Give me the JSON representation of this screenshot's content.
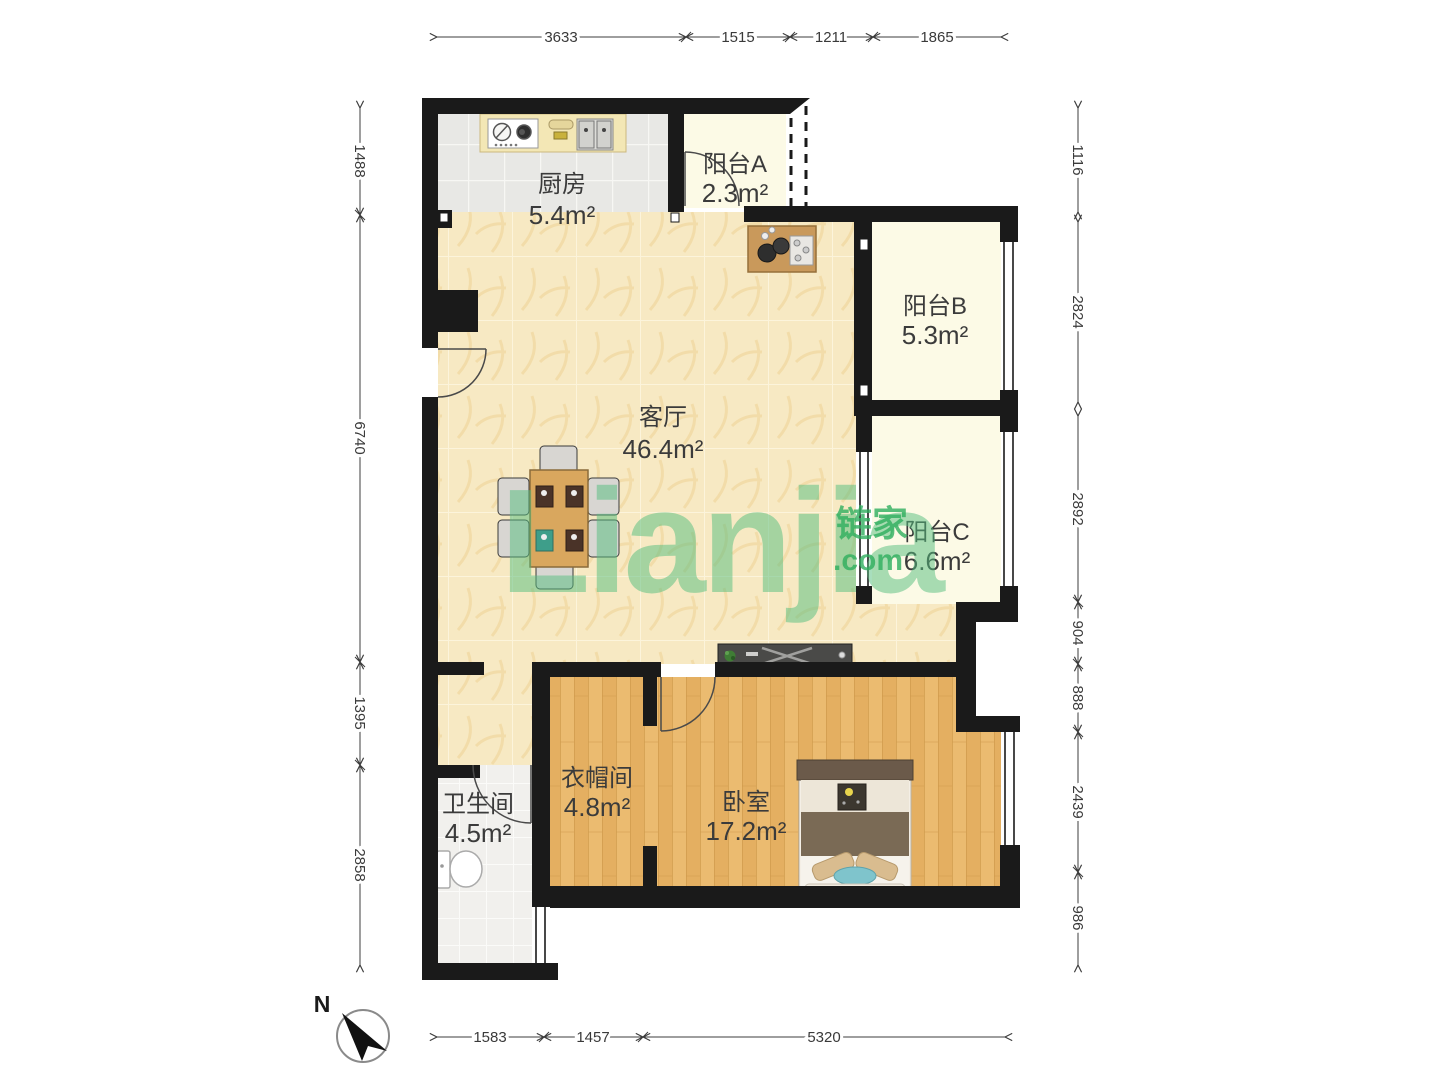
{
  "watermark": {
    "brand": "Lianjia",
    "tld": ".com",
    "cn": "链家"
  },
  "compass": {
    "north_label": "N"
  },
  "rooms": {
    "kitchen": {
      "name": "厨房",
      "area": "5.4m²"
    },
    "balcony_a": {
      "name": "阳台A",
      "area": "2.3m²"
    },
    "balcony_b": {
      "name": "阳台B",
      "area": "5.3m²"
    },
    "living": {
      "name": "客厅",
      "area": "46.4m²"
    },
    "balcony_c": {
      "name": "阳台C",
      "area": "6.6m²"
    },
    "bathroom": {
      "name": "卫生间",
      "area": "4.5m²"
    },
    "cloakroom": {
      "name": "衣帽间",
      "area": "4.8m²"
    },
    "bedroom": {
      "name": "卧室",
      "area": "17.2m²"
    }
  },
  "dimensions": {
    "top": [
      "3633",
      "1515",
      "1211",
      "1865"
    ],
    "bottom": [
      "1583",
      "1457",
      "5320"
    ],
    "left": [
      "1488",
      "6740",
      "1395",
      "2858"
    ],
    "right": [
      "1116",
      "2824",
      "2892",
      "904",
      "888",
      "2439",
      "986"
    ]
  }
}
